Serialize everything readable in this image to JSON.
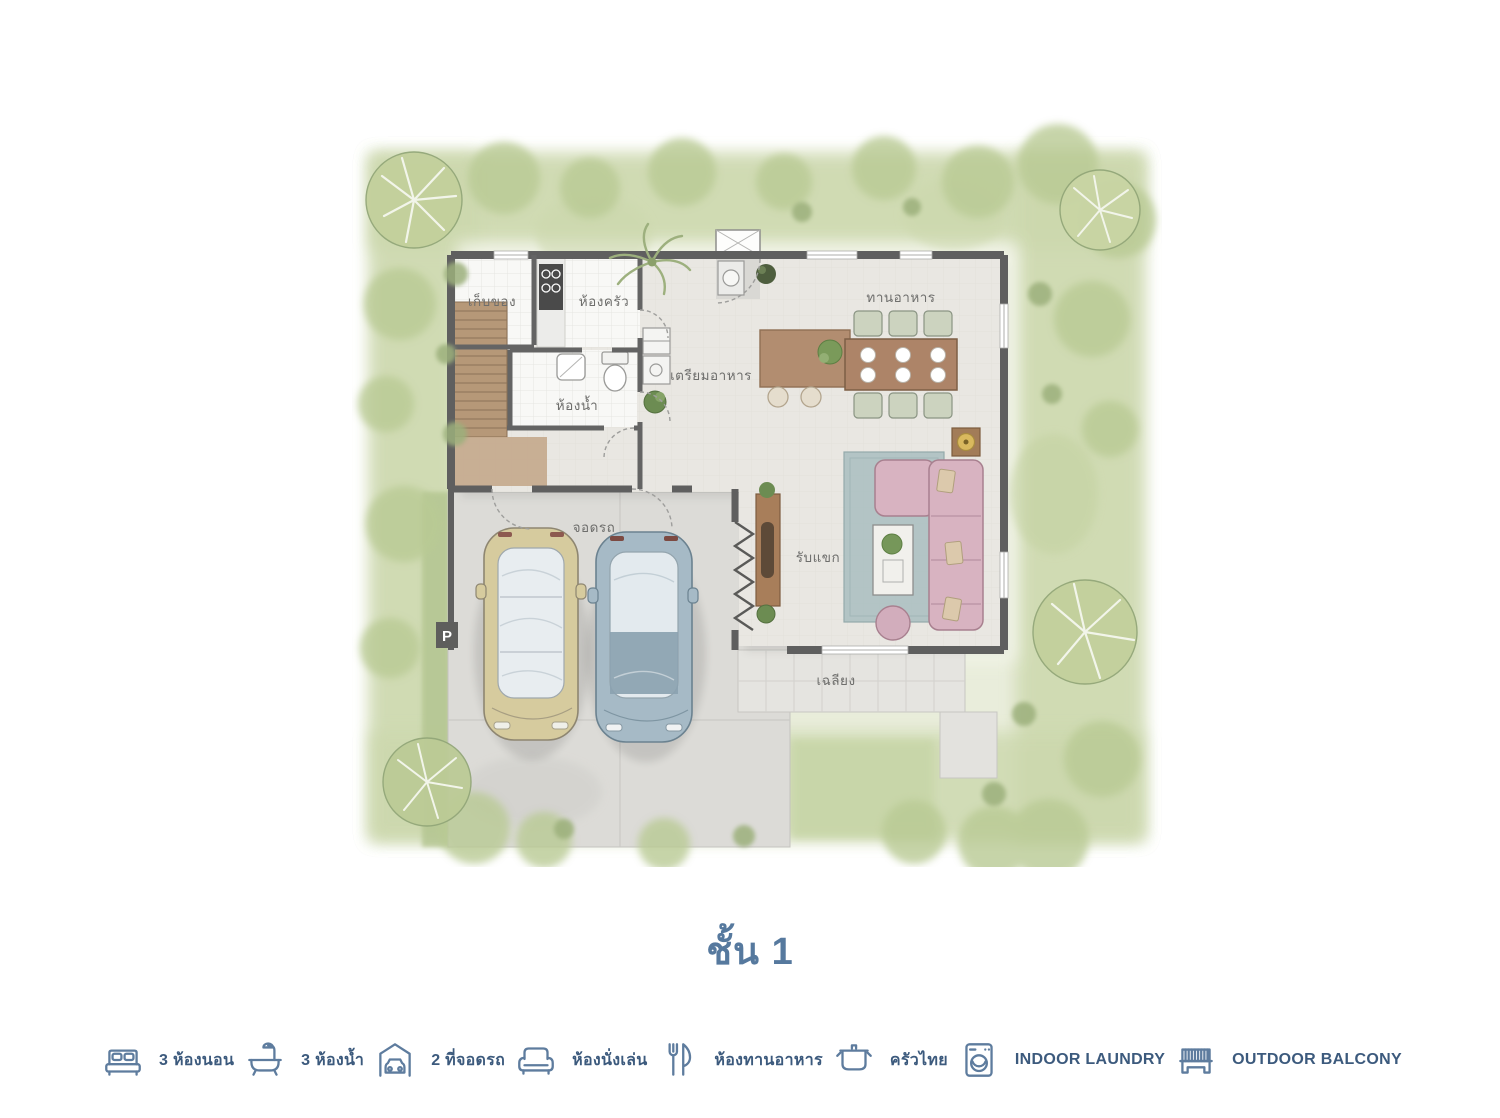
{
  "title": {
    "text": "ชั้น 1"
  },
  "floor_plan": {
    "rooms": [
      {
        "id": "storage",
        "label": "เก็บของ"
      },
      {
        "id": "kitchen",
        "label": "ห้องครัว"
      },
      {
        "id": "bathroom",
        "label": "ห้องน้ำ"
      },
      {
        "id": "prep",
        "label": "เตรียมอาหาร"
      },
      {
        "id": "dining",
        "label": "ทานอาหาร"
      },
      {
        "id": "parking",
        "label": "จอดรถ"
      },
      {
        "id": "living",
        "label": "รับแขก"
      },
      {
        "id": "porch",
        "label": "เฉลียง"
      }
    ],
    "parking_sign": "P"
  },
  "legend": {
    "items": [
      {
        "icon": "bed-icon",
        "label": "3 ห้องนอน"
      },
      {
        "icon": "bathtub-icon",
        "label": "3 ห้องน้ำ"
      },
      {
        "icon": "car-garage-icon",
        "label": "2 ที่จอดรถ"
      },
      {
        "icon": "sofa-icon",
        "label": "ห้องนั่งเล่น"
      },
      {
        "icon": "fork-knife-icon",
        "label": "ห้องทานอาหาร"
      },
      {
        "icon": "pot-icon",
        "label": "ครัวไทย"
      },
      {
        "icon": "washing-machine-icon",
        "label": "INDOOR LAUNDRY"
      },
      {
        "icon": "bench-icon",
        "label": "OUTDOOR BALCONY"
      }
    ]
  },
  "colors": {
    "title_color": "#56799e",
    "legend_label_color": "#3c5a7d",
    "legend_icon_color": "#5e7c9e",
    "wall": "#5f5f5f",
    "floor": "#e9e7e2",
    "garden_light": "#e7ecd8",
    "garden_dark": "#b9ca94",
    "driveway": "#dcdbd7",
    "stairs_wood": "#b69878",
    "sofa_pink": "#d8b3c1",
    "rug_teal": "#aabec0",
    "car_beige": "#d6cb9e",
    "car_blue": "#a6bac6",
    "table_wood": "#ad8468"
  }
}
